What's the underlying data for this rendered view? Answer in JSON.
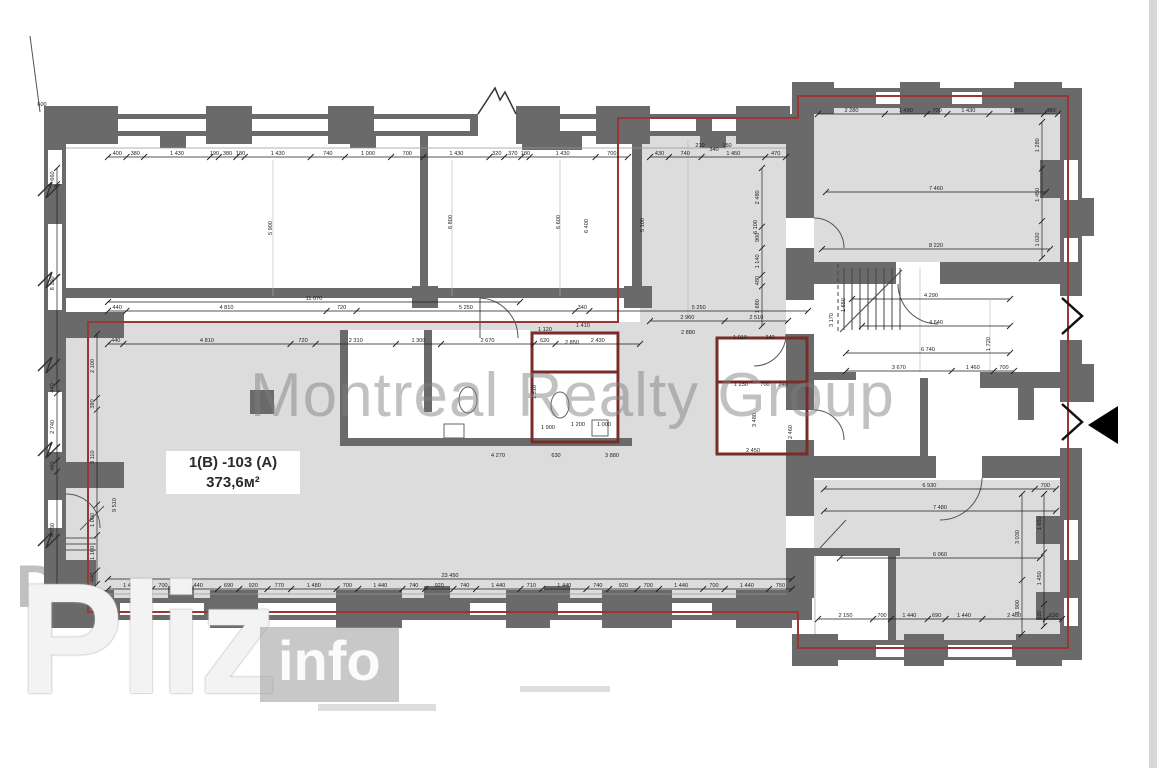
{
  "watermarks": {
    "center": "Montreal Realty Group",
    "bottom_left_large": "Pliz",
    "bottom_left_box": "info",
    "dom": "DOM"
  },
  "unit_label": {
    "line1": "1(В) -103 (А)",
    "line2": "373,6м²"
  },
  "colors": {
    "wall": "#6a6a6a",
    "room_fill": "#dcdcdc",
    "boundary_red": "#993832",
    "partition_maroon": "#7a2d28",
    "dim_line": "#1e1e1e",
    "watermark_gray": "#9a9a9a"
  },
  "icons": {
    "entrance_arrow": "left-pointing-black-triangle"
  },
  "chains": [
    {
      "id": "top-left-wall",
      "o": "h",
      "x": 108,
      "y": 157,
      "len": 520,
      "vals": [
        400,
        380,
        1430,
        190,
        380,
        180,
        1430,
        740,
        1000,
        700,
        1430,
        320,
        370,
        180,
        1430,
        700
      ]
    },
    {
      "id": "top-corridor",
      "o": "h",
      "x": 650,
      "y": 157,
      "len": 136,
      "vals": [
        430,
        740,
        1450,
        470
      ]
    },
    {
      "id": "total-11070",
      "o": "h",
      "x": 108,
      "y": 302,
      "len": 412,
      "vals": [
        11070
      ]
    },
    {
      "id": "mid-upper",
      "o": "h",
      "x": 108,
      "y": 311,
      "len": 700,
      "vals": [
        440,
        4810,
        720,
        5250,
        340,
        5250
      ]
    },
    {
      "id": "room-top",
      "o": "h",
      "x": 108,
      "y": 344,
      "len": 532,
      "vals": [
        440,
        4810,
        720,
        2310,
        1300,
        2670,
        620,
        2430
      ]
    },
    {
      "id": "total-23450",
      "o": "h",
      "x": 108,
      "y": 579,
      "len": 684,
      "vals": [
        23450
      ]
    },
    {
      "id": "bottom-main",
      "o": "h",
      "x": 108,
      "y": 589,
      "len": 684,
      "vals": [
        1440,
        700,
        1440,
        690,
        920,
        770,
        1480,
        700,
        1440,
        740,
        920,
        740,
        1440,
        710,
        1440,
        740,
        920,
        700,
        1440,
        700,
        1440,
        750
      ]
    },
    {
      "id": "wing-top-top",
      "o": "h",
      "x": 818,
      "y": 114,
      "len": 240,
      "vals": [
        2280,
        1430,
        700,
        1430,
        1860,
        480
      ]
    },
    {
      "id": "wing-top-mid",
      "o": "h",
      "x": 826,
      "y": 192,
      "len": 220,
      "vals": [
        7460
      ]
    },
    {
      "id": "wing-top-bot",
      "o": "h",
      "x": 822,
      "y": 249,
      "len": 228,
      "vals": [
        8220
      ]
    },
    {
      "id": "wing-bot-top",
      "o": "h",
      "x": 824,
      "y": 489,
      "len": 232,
      "vals": [
        6930,
        700
      ]
    },
    {
      "id": "wing-bot-mid",
      "o": "h",
      "x": 824,
      "y": 511,
      "len": 232,
      "vals": [
        7480
      ]
    },
    {
      "id": "wing-bot-low",
      "o": "h",
      "x": 840,
      "y": 558,
      "len": 200,
      "vals": [
        6060
      ]
    },
    {
      "id": "wing-bot-bot",
      "o": "h",
      "x": 818,
      "y": 619,
      "len": 244,
      "vals": [
        2150,
        700,
        1440,
        690,
        1440,
        2480,
        630
      ]
    },
    {
      "id": "corridor-mid",
      "o": "h",
      "x": 650,
      "y": 321,
      "len": 138,
      "vals": [
        2960,
        2510
      ]
    },
    {
      "id": "stair-1",
      "o": "h",
      "x": 852,
      "y": 299,
      "len": 158,
      "vals": [
        4290
      ]
    },
    {
      "id": "stair-2",
      "o": "h",
      "x": 862,
      "y": 326,
      "len": 148,
      "vals": [
        4640
      ]
    },
    {
      "id": "stair-3",
      "o": "h",
      "x": 846,
      "y": 353,
      "len": 164,
      "vals": [
        6740
      ]
    },
    {
      "id": "stair-4",
      "o": "h",
      "x": 846,
      "y": 371,
      "len": 168,
      "vals": [
        3670,
        1460,
        700
      ]
    },
    {
      "id": "left-outer",
      "o": "v",
      "x": 57,
      "y": 168,
      "len": 420,
      "vals": [
        660,
        8100,
        440,
        2740,
        460,
        4750
      ]
    },
    {
      "id": "left-inner",
      "o": "v",
      "x": 97,
      "y": 334,
      "len": 250,
      "vals": [
        2100,
        380,
        3110,
        1000,
        1160,
        440
      ]
    },
    {
      "id": "corridor-right",
      "o": "v",
      "x": 762,
      "y": 168,
      "len": 158,
      "vals": [
        2480,
        900,
        1140,
        480,
        1680
      ]
    },
    {
      "id": "wing-top-right",
      "o": "v",
      "x": 1042,
      "y": 122,
      "len": 136,
      "vals": [
        1280,
        1450,
        1020
      ]
    },
    {
      "id": "wing-bot-right-inner",
      "o": "v",
      "x": 1022,
      "y": 494,
      "len": 140,
      "vals": [
        3030,
        1900
      ]
    },
    {
      "id": "wing-bot-right-outer",
      "o": "v",
      "x": 1044,
      "y": 494,
      "len": 132,
      "vals": [
        1650,
        1450,
        620
      ]
    }
  ],
  "labels": [
    {
      "t": "600",
      "x": 42,
      "y": 106
    },
    {
      "t": "5 900",
      "x": 272,
      "y": 228,
      "r": -90
    },
    {
      "t": "6 800",
      "x": 452,
      "y": 222,
      "r": -90
    },
    {
      "t": "6 600",
      "x": 560,
      "y": 222,
      "r": -90
    },
    {
      "t": "6 400",
      "x": 588,
      "y": 226,
      "r": -90
    },
    {
      "t": "5 100",
      "x": 644,
      "y": 225,
      "r": -90
    },
    {
      "t": "6 100",
      "x": 757,
      "y": 227,
      "r": -90
    },
    {
      "t": "1 720",
      "x": 990,
      "y": 344,
      "r": -90
    },
    {
      "t": "1 650",
      "x": 845,
      "y": 305,
      "r": -90
    },
    {
      "t": "3 170",
      "x": 833,
      "y": 320,
      "r": -90
    },
    {
      "t": "2 880",
      "x": 688,
      "y": 334
    },
    {
      "t": "1 010",
      "x": 740,
      "y": 339
    },
    {
      "t": "340",
      "x": 770,
      "y": 339
    },
    {
      "t": "1 230",
      "x": 741,
      "y": 386
    },
    {
      "t": "700",
      "x": 765,
      "y": 386
    },
    {
      "t": "240",
      "x": 783,
      "y": 386
    },
    {
      "t": "2 450",
      "x": 753,
      "y": 452
    },
    {
      "t": "3 480",
      "x": 756,
      "y": 420,
      "r": -90
    },
    {
      "t": "2 460",
      "x": 792,
      "y": 432,
      "r": -90
    },
    {
      "t": "1 120",
      "x": 545,
      "y": 331
    },
    {
      "t": "1 410",
      "x": 583,
      "y": 327
    },
    {
      "t": "2 850",
      "x": 572,
      "y": 344
    },
    {
      "t": "1 510",
      "x": 536,
      "y": 392,
      "r": -90
    },
    {
      "t": "1 900",
      "x": 548,
      "y": 429
    },
    {
      "t": "1 200",
      "x": 578,
      "y": 426
    },
    {
      "t": "1 000",
      "x": 604,
      "y": 426
    },
    {
      "t": "4 270",
      "x": 498,
      "y": 457
    },
    {
      "t": "630",
      "x": 556,
      "y": 457
    },
    {
      "t": "3 880",
      "x": 612,
      "y": 457
    },
    {
      "t": "9 510",
      "x": 116,
      "y": 505,
      "r": -90
    },
    {
      "t": "210",
      "x": 700,
      "y": 147
    },
    {
      "t": "340",
      "x": 714,
      "y": 151
    },
    {
      "t": "150",
      "x": 727,
      "y": 147
    }
  ]
}
